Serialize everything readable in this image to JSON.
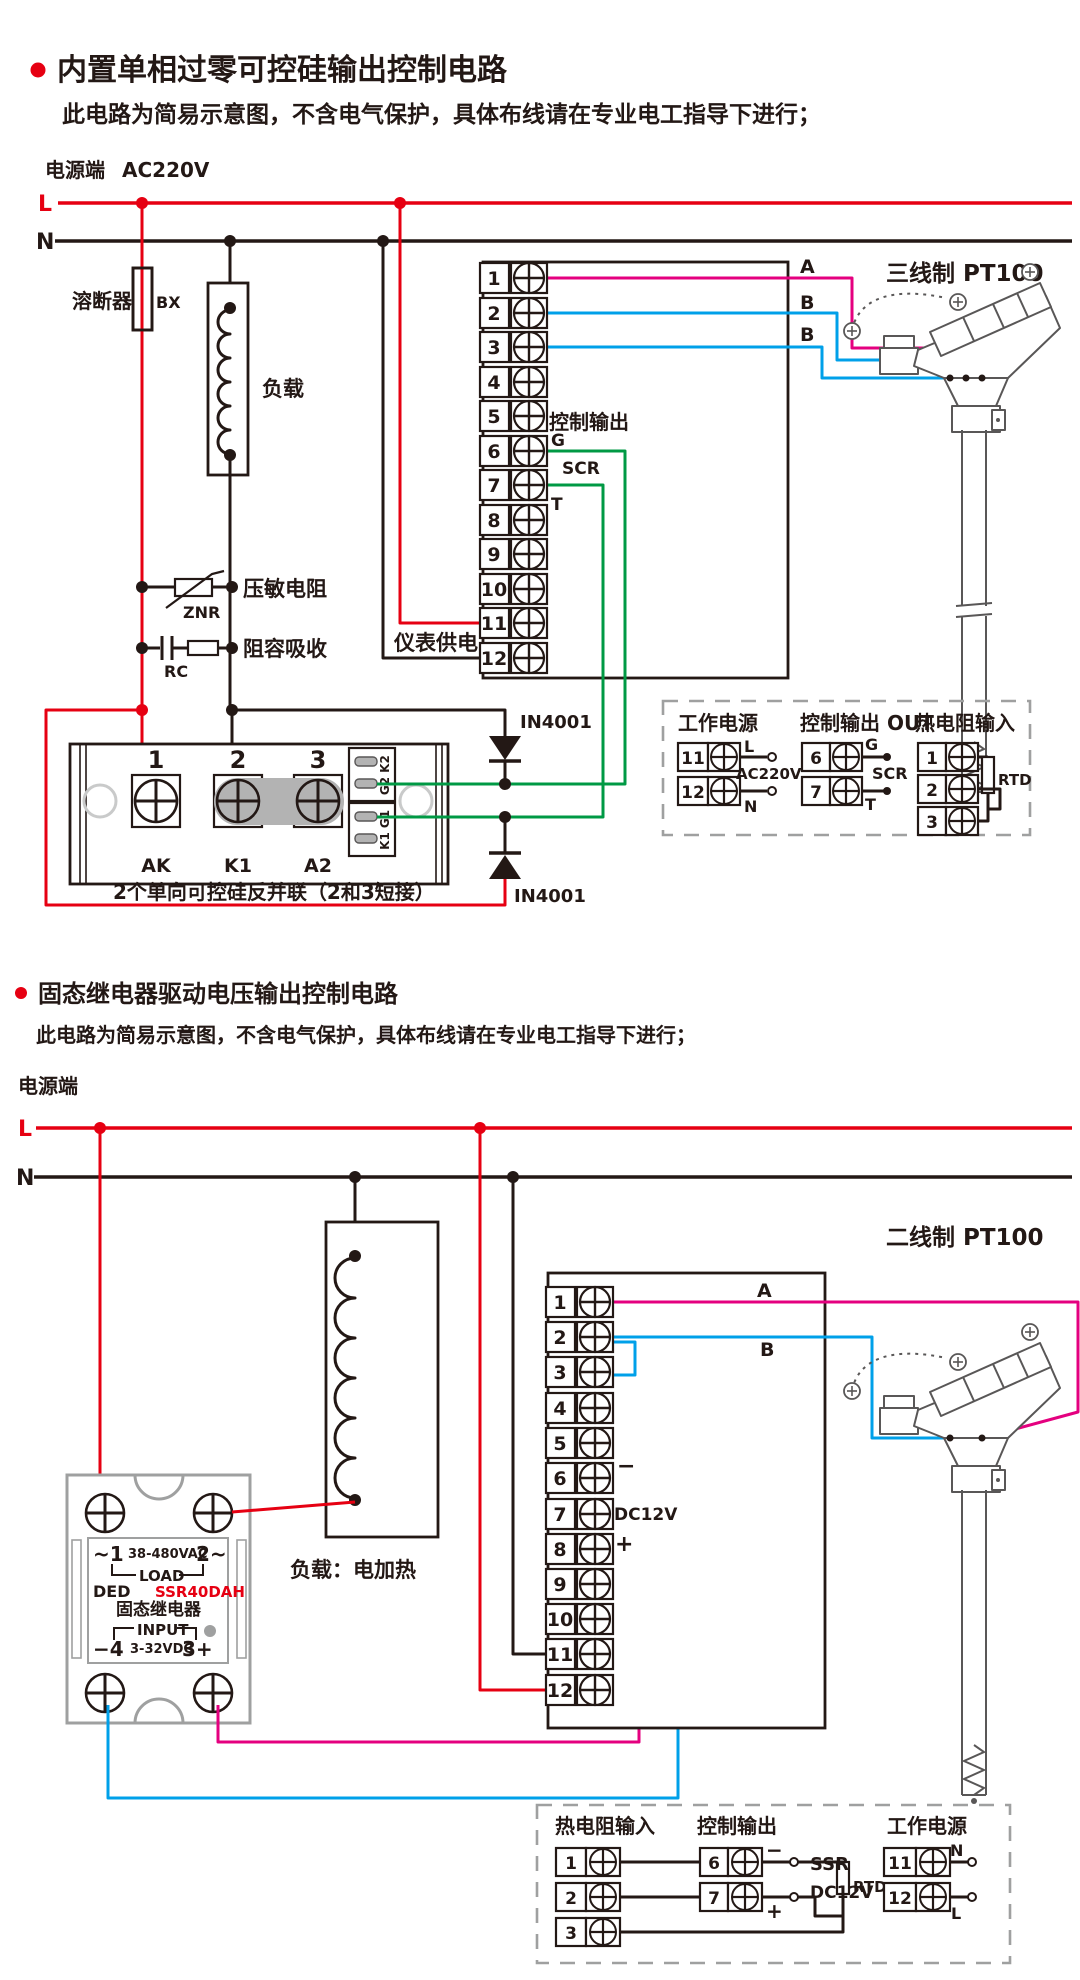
{
  "colors": {
    "line_live": "#e60012",
    "line_neutral": "#231815",
    "wire_a": "#e4007f",
    "wire_b": "#00a0e9",
    "wire_gate": "#009944",
    "module_gray": "#9fa0a0"
  },
  "terminals": [
    "1",
    "2",
    "3",
    "4",
    "5",
    "6",
    "7",
    "8",
    "9",
    "10",
    "11",
    "12"
  ],
  "c1": {
    "title": "内置单相过零可控硅输出控制电路",
    "subtitle": "此电路为简易示意图，不含电气保护，具体布线请在专业电工指导下进行；",
    "power_label": "电源端",
    "voltage": "AC220V",
    "l": "L",
    "n": "N",
    "fuse": "溶断器",
    "fuse_code": "BX",
    "load": "负载",
    "znr_label": "压敏电阻",
    "znr": "ZNR",
    "rc_label": "阻容吸收",
    "rc": "RC",
    "meter_supply": "仪表供电",
    "ctrl_out": "控制输出",
    "g": "G",
    "scr": "SCR",
    "t": "T",
    "a": "A",
    "b1": "B",
    "b2": "B",
    "sensor": "三线制 PT100",
    "diode1": "IN4001",
    "diode2": "IN4001",
    "m1": "1",
    "m2": "2",
    "m3": "3",
    "ak": "AK",
    "k1": "K1",
    "a2": "A2",
    "pk2": "K2",
    "pg2": "G2",
    "pg1": "G1",
    "pk1": "K1",
    "caption": "2个单向可控硅反并联（2和3短接）",
    "lg_power": "工作电源",
    "lg_out": "控制输出 OUT",
    "lg_rtd": "热电阻输入",
    "lg_l": "L",
    "lg_n": "N",
    "lg_ac": "AC220V",
    "lg_g": "G",
    "lg_scr": "SCR",
    "lg_t": "T",
    "lg_rtd_code": "RTD"
  },
  "c2": {
    "title": "固态继电器驱动电压输出控制电路",
    "subtitle": "此电路为简易示意图，不含电气保护，具体布线请在专业电工指导下进行；",
    "power_label": "电源端",
    "l": "L",
    "n": "N",
    "load": "负载：电加热",
    "sensor": "二线制 PT100",
    "a": "A",
    "b": "B",
    "minus": "−",
    "plus": "+",
    "dc12v": "DC12V",
    "ssr_t1": "~1",
    "ssr_vac": "38-480VAC",
    "ssr_t2": "2~",
    "ssr_load": "LOAD",
    "ssr_ded": "DED",
    "ssr_model": "SSR40DAH",
    "ssr_name": "固态继电器",
    "ssr_input": "INPUT",
    "ssr_m4": "−4",
    "ssr_vdc": "3-32VDC",
    "ssr_p3": "3+",
    "lg_rtd": "热电阻输入",
    "lg_out": "控制输出",
    "lg_power": "工作电源",
    "lg_rtd_code": "RTD",
    "lg_ssr": "SSR",
    "lg_dc": "DC12V",
    "lg_minus": "−",
    "lg_plus": "+",
    "lg_n": "N",
    "lg_l": "L"
  }
}
